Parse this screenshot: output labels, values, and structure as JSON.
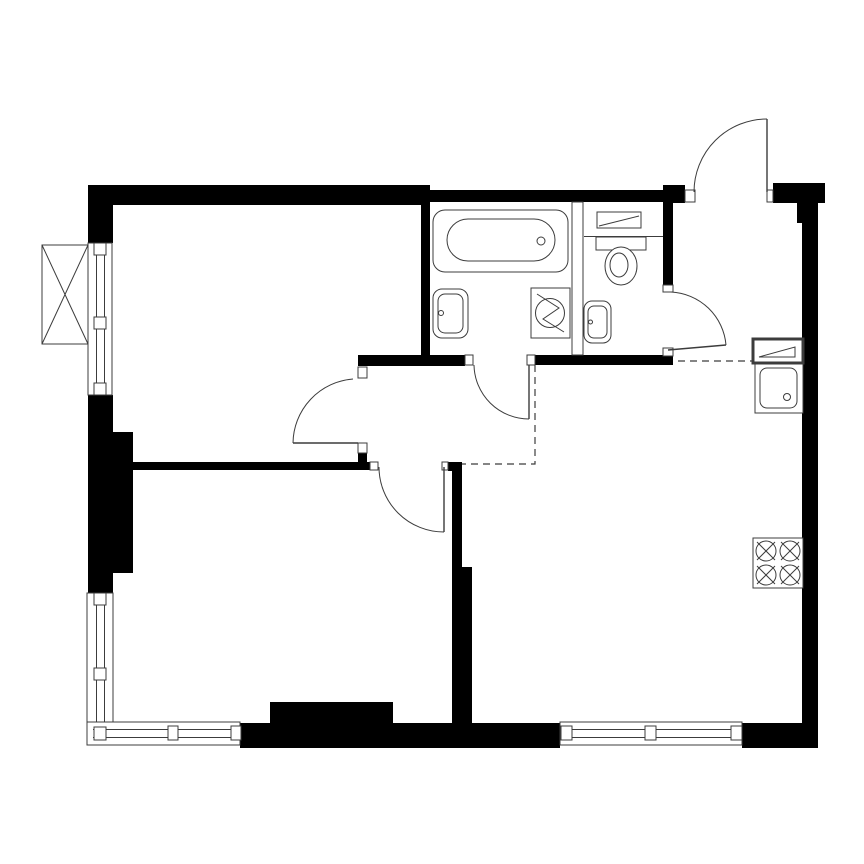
{
  "canvas": {
    "width": 864,
    "height": 864,
    "background": "#ffffff",
    "wall_color": "#000000",
    "line_color": "#3c3c3c",
    "dash_pattern": "7 5"
  },
  "shapes": [
    {
      "n": "wall-top-left",
      "kind": "rect",
      "x": 88,
      "y": 185,
      "w": 342,
      "h": 20
    },
    {
      "n": "wall-top-bathroom",
      "kind": "rect",
      "x": 430,
      "y": 190,
      "w": 243,
      "h": 12
    },
    {
      "n": "wall-top-entry-left",
      "kind": "rect",
      "x": 663,
      "y": 185,
      "w": 22,
      "h": 18
    },
    {
      "n": "wall-top-entry-right",
      "kind": "rect",
      "x": 773,
      "y": 183,
      "w": 52,
      "h": 20
    },
    {
      "n": "wall-entry-stub",
      "kind": "rect",
      "x": 797,
      "y": 203,
      "w": 21,
      "h": 20
    },
    {
      "n": "wall-right",
      "kind": "rect",
      "x": 802,
      "y": 203,
      "w": 16,
      "h": 520
    },
    {
      "n": "wall-bottom-right",
      "kind": "rect",
      "x": 742,
      "y": 723,
      "w": 76,
      "h": 25
    },
    {
      "n": "wall-bottom-middle",
      "kind": "rect",
      "x": 240,
      "y": 723,
      "w": 320,
      "h": 25
    },
    {
      "n": "wall-bottom-ledge",
      "kind": "rect",
      "x": 270,
      "y": 702,
      "w": 123,
      "h": 21
    },
    {
      "n": "wall-left-top",
      "kind": "rect",
      "x": 88,
      "y": 185,
      "w": 25,
      "h": 58
    },
    {
      "n": "wall-left-mid",
      "kind": "rect",
      "x": 88,
      "y": 395,
      "w": 25,
      "h": 37
    },
    {
      "n": "wall-left-pier",
      "kind": "rect",
      "x": 88,
      "y": 432,
      "w": 45,
      "h": 141
    },
    {
      "n": "wall-left-lower",
      "kind": "rect",
      "x": 88,
      "y": 573,
      "w": 25,
      "h": 20
    },
    {
      "n": "wall-bathroom-left",
      "kind": "rect",
      "x": 421,
      "y": 203,
      "w": 9,
      "h": 153
    },
    {
      "n": "wall-hall-top",
      "kind": "rect",
      "x": 358,
      "y": 355,
      "w": 107,
      "h": 11
    },
    {
      "n": "wall-wc-bottom",
      "kind": "rect",
      "x": 535,
      "y": 355,
      "w": 138,
      "h": 10
    },
    {
      "n": "wall-wc-right-upper",
      "kind": "rect",
      "x": 663,
      "y": 202,
      "w": 10,
      "h": 83
    },
    {
      "n": "wall-room-door-stub",
      "kind": "rect",
      "x": 358,
      "y": 453,
      "w": 9,
      "h": 10
    },
    {
      "n": "wall-bedroom-top",
      "kind": "rect",
      "x": 113,
      "y": 462,
      "w": 257,
      "h": 8
    },
    {
      "n": "wall-bedroom-corner",
      "kind": "rect",
      "x": 448,
      "y": 462,
      "w": 14,
      "h": 9
    },
    {
      "n": "wall-bedroom-living-thin",
      "kind": "rect",
      "x": 452,
      "y": 462,
      "w": 10,
      "h": 105
    },
    {
      "n": "wall-bedroom-living-thick",
      "kind": "rect",
      "x": 452,
      "y": 567,
      "w": 20,
      "h": 156
    },
    {
      "n": "window-livingroom-sill",
      "kind": "rect",
      "x": 88,
      "y": 243,
      "w": 24,
      "h": 152,
      "f": "w",
      "sw": 1
    },
    {
      "n": "window-livingroom-pane-line",
      "kind": "line",
      "x1": 96.5,
      "y1": 247,
      "x2": 96.5,
      "y2": 391
    },
    {
      "n": "window-livingroom-pane-line",
      "kind": "line",
      "x1": 104.5,
      "y1": 247,
      "x2": 104.5,
      "y2": 391
    },
    {
      "n": "window-livingroom-cap",
      "kind": "rect",
      "x": 94,
      "y": 243,
      "w": 12,
      "h": 12,
      "f": "w",
      "sw": 1
    },
    {
      "n": "window-livingroom-cap",
      "kind": "rect",
      "x": 94,
      "y": 317,
      "w": 12,
      "h": 12,
      "f": "w",
      "sw": 1
    },
    {
      "n": "window-livingroom-cap",
      "kind": "rect",
      "x": 94,
      "y": 383,
      "w": 12,
      "h": 12,
      "f": "w",
      "sw": 1
    },
    {
      "n": "window-bedroom-left-sill",
      "kind": "rect",
      "x": 87,
      "y": 593,
      "w": 26,
      "h": 152,
      "f": "w",
      "sw": 1
    },
    {
      "n": "window-bedroom-left-pane-line",
      "kind": "line",
      "x1": 96.5,
      "y1": 597,
      "x2": 96.5,
      "y2": 740
    },
    {
      "n": "window-bedroom-left-pane-line",
      "kind": "line",
      "x1": 104.5,
      "y1": 597,
      "x2": 104.5,
      "y2": 740
    },
    {
      "n": "window-bedroom-bottom-sill",
      "kind": "rect",
      "x": 87,
      "y": 722,
      "w": 153,
      "h": 23,
      "f": "w",
      "sw": 1
    },
    {
      "n": "window-bedroom-bottom-pane-line",
      "kind": "line",
      "x1": 93,
      "y1": 729.5,
      "x2": 238,
      "y2": 729.5
    },
    {
      "n": "window-bedroom-bottom-pane-line",
      "kind": "line",
      "x1": 93,
      "y1": 737.5,
      "x2": 238,
      "y2": 737.5
    },
    {
      "n": "window-bedroom-cap",
      "kind": "rect",
      "x": 94,
      "y": 593,
      "w": 12,
      "h": 12,
      "f": "w",
      "sw": 1
    },
    {
      "n": "window-bedroom-cap",
      "kind": "rect",
      "x": 94,
      "y": 668,
      "w": 12,
      "h": 12,
      "f": "w",
      "sw": 1
    },
    {
      "n": "window-bedroom-corner-cap",
      "kind": "rect",
      "x": 94,
      "y": 727,
      "w": 12,
      "h": 13,
      "f": "w",
      "sw": 1
    },
    {
      "n": "window-bedroom-cap",
      "kind": "rect",
      "x": 168,
      "y": 726,
      "w": 10,
      "h": 14,
      "f": "w",
      "sw": 1
    },
    {
      "n": "window-bedroom-cap",
      "kind": "rect",
      "x": 231,
      "y": 726,
      "w": 10,
      "h": 14,
      "f": "w",
      "sw": 1
    },
    {
      "n": "window-living-bottom-sill",
      "kind": "rect",
      "x": 560,
      "y": 722,
      "w": 182,
      "h": 23,
      "f": "w",
      "sw": 1
    },
    {
      "n": "window-living-bottom-pane-line",
      "kind": "line",
      "x1": 566,
      "y1": 729.5,
      "x2": 737,
      "y2": 729.5
    },
    {
      "n": "window-living-bottom-pane-line",
      "kind": "line",
      "x1": 566,
      "y1": 737.5,
      "x2": 737,
      "y2": 737.5
    },
    {
      "n": "window-living-cap",
      "kind": "rect",
      "x": 561,
      "y": 726,
      "w": 11,
      "h": 14,
      "f": "w",
      "sw": 1
    },
    {
      "n": "window-living-cap",
      "kind": "rect",
      "x": 645,
      "y": 726,
      "w": 11,
      "h": 14,
      "f": "w",
      "sw": 1
    },
    {
      "n": "window-living-cap",
      "kind": "rect",
      "x": 731,
      "y": 726,
      "w": 11,
      "h": 14,
      "f": "w",
      "sw": 1
    },
    {
      "n": "vent-shaft-box",
      "kind": "rect",
      "x": 42,
      "y": 245,
      "w": 46,
      "h": 99,
      "f": "w",
      "sw": 1
    },
    {
      "n": "vent-shaft-diagonal",
      "kind": "line",
      "x1": 42,
      "y1": 245,
      "x2": 88,
      "y2": 344
    },
    {
      "n": "vent-shaft-diagonal",
      "kind": "line",
      "x1": 88,
      "y1": 245,
      "x2": 42,
      "y2": 344
    },
    {
      "n": "wall-partition-bath-wc",
      "kind": "rect",
      "x": 572,
      "y": 202,
      "w": 11,
      "h": 153,
      "f": "w",
      "sw": 1
    },
    {
      "n": "post-entry-left",
      "kind": "rect",
      "x": 685,
      "y": 190,
      "w": 10,
      "h": 12,
      "f": "w",
      "sw": 1
    },
    {
      "n": "post-entry-right",
      "kind": "rect",
      "x": 767,
      "y": 190,
      "w": 6,
      "h": 12,
      "f": "w",
      "sw": 1
    },
    {
      "n": "post-wc-top",
      "kind": "rect",
      "x": 663,
      "y": 285,
      "w": 10,
      "h": 7,
      "f": "w",
      "sw": 1
    },
    {
      "n": "post-wc-bottom",
      "kind": "rect",
      "x": 663,
      "y": 348,
      "w": 10,
      "h": 8,
      "f": "w",
      "sw": 1
    },
    {
      "n": "post-bath-left",
      "kind": "rect",
      "x": 465,
      "y": 355,
      "w": 8,
      "h": 10,
      "f": "w",
      "sw": 1
    },
    {
      "n": "post-bath-right",
      "kind": "rect",
      "x": 527,
      "y": 355,
      "w": 8,
      "h": 10,
      "f": "w",
      "sw": 1
    },
    {
      "n": "post-room-top",
      "kind": "rect",
      "x": 358,
      "y": 367,
      "w": 9,
      "h": 11,
      "f": "w",
      "sw": 1
    },
    {
      "n": "post-room-bottom",
      "kind": "rect",
      "x": 358,
      "y": 443,
      "w": 9,
      "h": 10,
      "f": "w",
      "sw": 1
    },
    {
      "n": "post-bedroom-left",
      "kind": "rect",
      "x": 370,
      "y": 462,
      "w": 8,
      "h": 8,
      "f": "w",
      "sw": 1
    },
    {
      "n": "post-bedroom-right",
      "kind": "rect",
      "x": 442,
      "y": 462,
      "w": 6,
      "h": 8,
      "f": "w",
      "sw": 1
    },
    {
      "n": "bathtub-outer",
      "kind": "rect",
      "x": 433,
      "y": 210,
      "w": 135,
      "h": 62,
      "rx": 12,
      "f": "w",
      "sw": 1
    },
    {
      "n": "bathtub-inner",
      "kind": "rect",
      "x": 447,
      "y": 219,
      "w": 108,
      "h": 42,
      "rx": 21,
      "f": "n",
      "sw": 1
    },
    {
      "n": "bathtub-drain",
      "kind": "circle",
      "cx": 541,
      "cy": 241,
      "r": 4
    },
    {
      "n": "bathroom-sink-outer",
      "kind": "rect",
      "x": 433,
      "y": 289,
      "w": 35,
      "h": 49,
      "rx": 9,
      "f": "w",
      "sw": 1
    },
    {
      "n": "bathroom-sink-inner",
      "kind": "rect",
      "x": 438,
      "y": 294,
      "w": 25,
      "h": 39,
      "rx": 7,
      "f": "n",
      "sw": 1
    },
    {
      "n": "bathroom-sink-tap",
      "kind": "circle",
      "cx": 441,
      "cy": 313,
      "r": 2.5
    },
    {
      "n": "washing-machine-box",
      "kind": "rect",
      "x": 531,
      "y": 288,
      "w": 39,
      "h": 50,
      "f": "w",
      "sw": 1
    },
    {
      "n": "washing-machine-drum",
      "kind": "circle",
      "cx": 550,
      "cy": 313,
      "r": 14.5
    },
    {
      "n": "washing-machine-bolt",
      "kind": "path",
      "d": "M 537 294 L 559 308 L 543 319 L 564 332"
    },
    {
      "n": "wc-shelf",
      "kind": "rect",
      "x": 597,
      "y": 212,
      "w": 44,
      "h": 16,
      "f": "w",
      "sw": 1
    },
    {
      "n": "wc-shelf-diagonal",
      "kind": "line",
      "x1": 599,
      "y1": 226,
      "x2": 639,
      "y2": 216
    },
    {
      "n": "wc-ledge-line",
      "kind": "line",
      "x1": 584,
      "y1": 236.5,
      "x2": 663,
      "y2": 236.5
    },
    {
      "n": "toilet-tank",
      "kind": "rect",
      "x": 596,
      "y": 237,
      "w": 50,
      "h": 13,
      "f": "w",
      "sw": 1
    },
    {
      "n": "toilet-bowl-outer",
      "kind": "ellipse",
      "cx": 621,
      "cy": 266,
      "rx": 16,
      "ry": 19,
      "f": "w",
      "sw": 1
    },
    {
      "n": "toilet-bowl-inner",
      "kind": "ellipse",
      "cx": 619,
      "cy": 265,
      "rx": 9,
      "ry": 12,
      "f": "n",
      "sw": 1
    },
    {
      "n": "wc-sink-outer",
      "kind": "rect",
      "x": 584,
      "y": 301,
      "w": 27,
      "h": 42,
      "rx": 8,
      "f": "w",
      "sw": 1
    },
    {
      "n": "wc-sink-inner",
      "kind": "rect",
      "x": 588,
      "y": 306,
      "w": 19,
      "h": 32,
      "rx": 6,
      "f": "n",
      "sw": 1
    },
    {
      "n": "wc-sink-tap",
      "kind": "circle",
      "cx": 590.5,
      "cy": 322,
      "r": 2
    },
    {
      "n": "kitchen-counter-box",
      "kind": "rect",
      "x": 753,
      "y": 339,
      "w": 50,
      "h": 24,
      "f": "w",
      "sw": 3
    },
    {
      "n": "kitchen-counter-flap",
      "kind": "path",
      "d": "M 759 357 L 795 357 L 795 347 Z"
    },
    {
      "n": "kitchen-sink-unit",
      "kind": "rect",
      "x": 755,
      "y": 364,
      "w": 48,
      "h": 49,
      "f": "w",
      "sw": 1
    },
    {
      "n": "kitchen-sink-basin",
      "kind": "rect",
      "x": 760,
      "y": 368,
      "w": 37,
      "h": 40,
      "rx": 7,
      "f": "n",
      "sw": 1
    },
    {
      "n": "kitchen-sink-drain",
      "kind": "circle",
      "cx": 787,
      "cy": 397,
      "r": 3.5
    },
    {
      "n": "stove-box",
      "kind": "rect",
      "x": 753,
      "y": 538,
      "w": 50,
      "h": 50,
      "f": "w",
      "sw": 1
    },
    {
      "n": "stove-burner",
      "kind": "circle",
      "cx": 766,
      "cy": 551,
      "r": 10
    },
    {
      "n": "stove-burner",
      "kind": "circle",
      "cx": 790,
      "cy": 551,
      "r": 10
    },
    {
      "n": "stove-burner",
      "kind": "circle",
      "cx": 766,
      "cy": 575,
      "r": 10
    },
    {
      "n": "stove-burner",
      "kind": "circle",
      "cx": 790,
      "cy": 575,
      "r": 10
    },
    {
      "n": "stove-burner-cross",
      "kind": "line",
      "x1": 757,
      "y1": 542,
      "x2": 775,
      "y2": 560
    },
    {
      "n": "stove-burner-cross",
      "kind": "line",
      "x1": 757,
      "y1": 560,
      "x2": 775,
      "y2": 542
    },
    {
      "n": "stove-burner-cross",
      "kind": "line",
      "x1": 781,
      "y1": 542,
      "x2": 799,
      "y2": 560
    },
    {
      "n": "stove-burner-cross",
      "kind": "line",
      "x1": 781,
      "y1": 560,
      "x2": 799,
      "y2": 542
    },
    {
      "n": "stove-burner-cross",
      "kind": "line",
      "x1": 757,
      "y1": 566,
      "x2": 775,
      "y2": 584
    },
    {
      "n": "stove-burner-cross",
      "kind": "line",
      "x1": 757,
      "y1": 584,
      "x2": 775,
      "y2": 566
    },
    {
      "n": "stove-burner-cross",
      "kind": "line",
      "x1": 781,
      "y1": 566,
      "x2": 799,
      "y2": 584
    },
    {
      "n": "stove-burner-cross",
      "kind": "line",
      "x1": 781,
      "y1": 584,
      "x2": 799,
      "y2": 566
    },
    {
      "n": "entrance-door-leaf",
      "kind": "line",
      "x1": 767,
      "y1": 119,
      "x2": 767,
      "y2": 192,
      "sw": 1.4
    },
    {
      "n": "entrance-door-swing",
      "kind": "path",
      "d": "M 694 192 A 73 73 0 0 1 767 119"
    },
    {
      "n": "wc-door-leaf",
      "kind": "line",
      "x1": 668,
      "y1": 350,
      "x2": 726,
      "y2": 345,
      "sw": 1.4
    },
    {
      "n": "wc-door-swing",
      "kind": "path",
      "d": "M 671 292 A 58 58 0 0 1 726 345"
    },
    {
      "n": "bathroom-door-leaf",
      "kind": "line",
      "x1": 529,
      "y1": 365,
      "x2": 529,
      "y2": 419,
      "sw": 1.4
    },
    {
      "n": "bathroom-door-swing",
      "kind": "path",
      "d": "M 474 365 A 55 55 0 0 0 529 419"
    },
    {
      "n": "livingroom-door-leaf",
      "kind": "line",
      "x1": 293,
      "y1": 443,
      "x2": 358,
      "y2": 443,
      "sw": 1.4
    },
    {
      "n": "livingroom-door-swing",
      "kind": "path",
      "d": "M 293 443 A 65 65 0 0 1 353 379"
    },
    {
      "n": "bedroom-door-leaf",
      "kind": "line",
      "x1": 444,
      "y1": 467,
      "x2": 444,
      "y2": 532,
      "sw": 1.4
    },
    {
      "n": "bedroom-door-swing",
      "kind": "path",
      "d": "M 379 467 A 65 65 0 0 0 444 532"
    },
    {
      "n": "zone-boundary-dashed",
      "kind": "path",
      "d": "M 678 361 L 753 361",
      "dash": true,
      "sw": 1.2
    },
    {
      "n": "zone-boundary-dashed",
      "kind": "path",
      "d": "M 535 365 L 535 464 L 462 464",
      "dash": true,
      "sw": 1.2
    }
  ]
}
